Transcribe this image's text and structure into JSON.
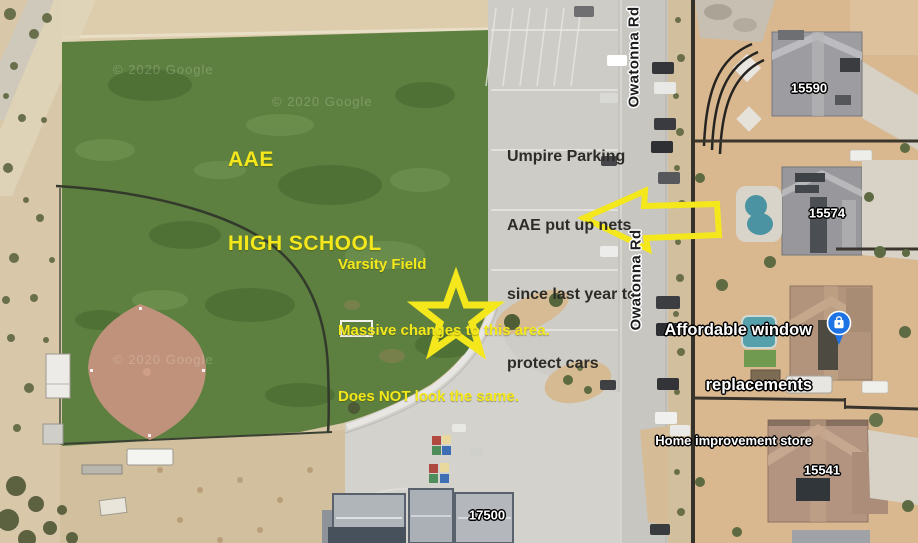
{
  "annotations": {
    "school": {
      "line1": "AAE",
      "line2": "HIGH SCHOOL"
    },
    "umpire": {
      "line1": "Umpire Parking",
      "line2": "AAE put up nets",
      "line3": "since last year to",
      "line4": "protect cars"
    },
    "varsity": {
      "line1": "Varsity Field",
      "line2": "Massive changes to this area.",
      "line3": "Does NOT look the same."
    },
    "annotation_yellow": "#f4e81c",
    "note_text_color": "#2d2c28"
  },
  "map_labels": {
    "road_top": "Owatonna Rd",
    "road_bottom": "Owatonna Rd",
    "address_15590": "15590",
    "address_15574": "15574",
    "address_15541": "15541",
    "address_17500": "17500",
    "watermark": "© 2020 Google"
  },
  "business": {
    "name_line1": "Affordable window",
    "name_line2": "replacements",
    "category": "Home improvement store",
    "pin_icon": "shopping-bag-pin",
    "pin_color": "#1d73e3"
  },
  "terrain_colors": {
    "grass": "#5d8040",
    "desert": "#d8c7a8",
    "residential_dirt": "#d9b88f",
    "concrete": "#cdccc7",
    "infield_clay": "#c0927c",
    "pool_water": "#4b93a2",
    "road": "#c7c6c1"
  }
}
